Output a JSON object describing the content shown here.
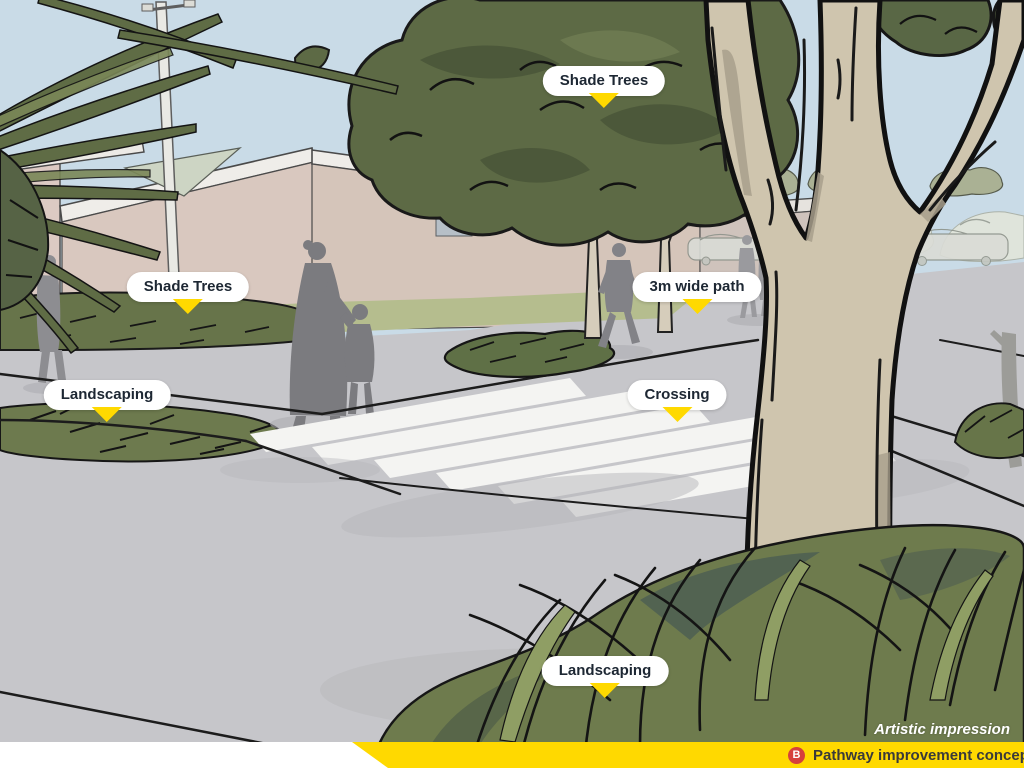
{
  "labels": [
    {
      "text": "Shade Trees",
      "x": 604,
      "y": 81
    },
    {
      "text": "Shade Trees",
      "x": 188,
      "y": 287
    },
    {
      "text": "3m wide path",
      "x": 697,
      "y": 287
    },
    {
      "text": "Landscaping",
      "x": 107,
      "y": 395
    },
    {
      "text": "Crossing",
      "x": 677,
      "y": 395
    },
    {
      "text": "Landscaping",
      "x": 605,
      "y": 671
    }
  ],
  "footer": {
    "attribution": "Artistic impression",
    "badge": "B",
    "caption": "Pathway improvement concept sketch"
  },
  "colors": {
    "callout_pointer_yellow": "#ffd900",
    "footer_bar_yellow": "#ffd900",
    "badge_red": "#d6403c",
    "sky_blue": "#c9dbe7",
    "path_gray": "#c6c6ca",
    "foliage_green": "#5d6a45",
    "grass_green": "#6e7b4d"
  },
  "icons": [
    "pointer-triangle-icon",
    "badge-b-icon"
  ]
}
